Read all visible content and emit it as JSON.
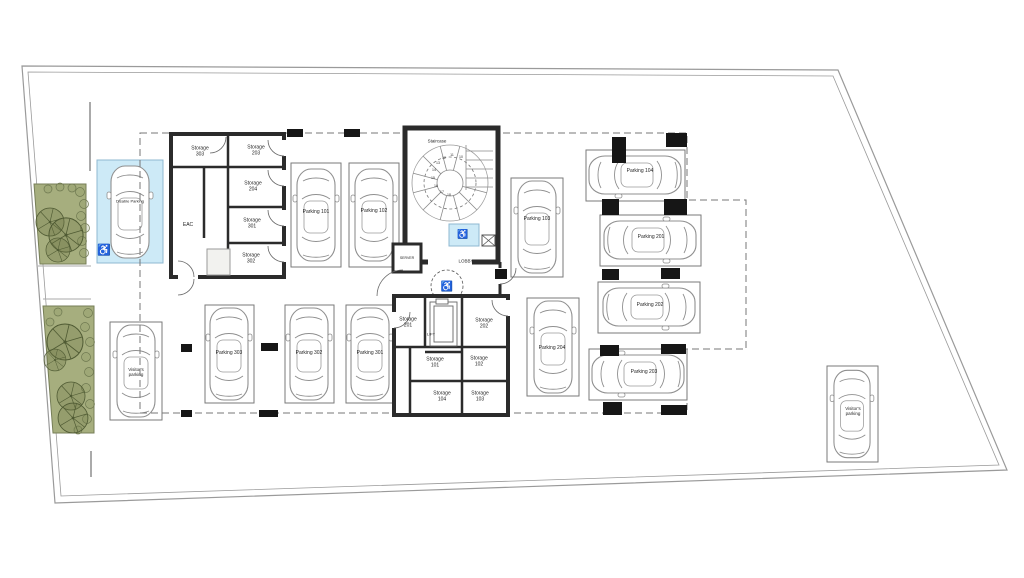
{
  "rooms": {
    "staircase": "Staircase",
    "lobby": "LOBBY",
    "lift": "LIFT",
    "server": "SERVER",
    "eac": "EAC"
  },
  "storages": {
    "s101": "Storage 101",
    "s102": "Storage 102",
    "s103": "Storage 103",
    "s104": "Storage 104",
    "s201": "Storage 201",
    "s202": "Storage 202",
    "s203": "Storage 203",
    "s204": "Storage 204",
    "s301": "Storage 301",
    "s302": "Storage 302",
    "s303": "Storage 303"
  },
  "parking": {
    "p101": "Parking 101",
    "p102": "Parking 102",
    "p103": "Parking 103",
    "p104": "Parking 104",
    "p201": "Parking 201",
    "p202": "Parking 202",
    "p203": "Parking 203",
    "p204": "Parking 204",
    "p301": "Parking 301",
    "p302": "Parking 302",
    "p303": "Parking 303",
    "disabled": "Disable Parking",
    "visitor_left": "Visitor's parking",
    "visitor_right": "Visitor's parking"
  },
  "stair_steps": [
    "10",
    "11",
    "12",
    "13",
    "14",
    "15",
    "16",
    "17",
    "18"
  ],
  "icons": {
    "wheelchair": "♿"
  },
  "colors": {
    "disabled_bay_blue": "#cdeaf7",
    "landscape_green": "#a6ae7e",
    "tree_green": "#4f5a33",
    "wall_dark": "#2b2b2b"
  }
}
